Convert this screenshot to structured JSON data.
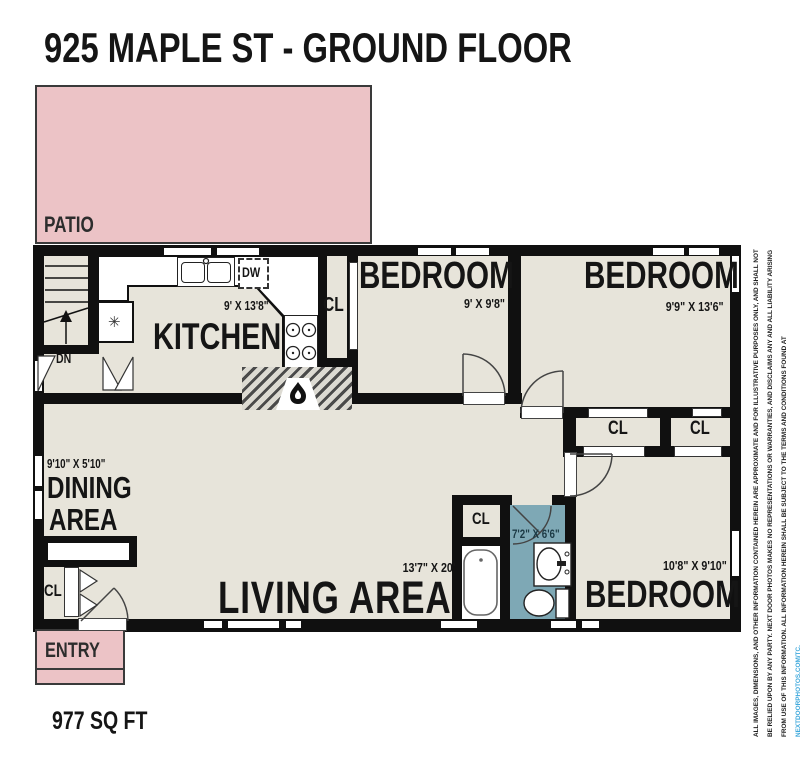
{
  "title": "925 MAPLE ST - GROUND FLOOR",
  "footer": {
    "area": "977 SQ FT"
  },
  "outdoor": {
    "patio": "PATIO",
    "entry": "ENTRY"
  },
  "rooms": {
    "kitchen": {
      "name": "KITCHEN",
      "dims": "9' X 13'8\""
    },
    "bedroom_top_left": {
      "name": "BEDROOM",
      "dims": "9' X 9'8\""
    },
    "bedroom_top_right": {
      "name": "BEDROOM",
      "dims": "9'9\" X 13'6\""
    },
    "bedroom_bottom_right": {
      "name": "BEDROOM",
      "dims": "10'8\" X 9'10\""
    },
    "dining": {
      "name_line1": "DINING",
      "name_line2": "AREA",
      "dims": "9'10\" X 5'10\""
    },
    "living": {
      "name": "LIVING AREA",
      "dims": "13'7\" X 20'"
    },
    "bathroom": {
      "dims": "7'2\" X 6'6\""
    }
  },
  "labels": {
    "closet": "CL",
    "stairs_down": "DN",
    "dishwasher": "DW",
    "snowflake": "✳"
  },
  "disclaimer": {
    "text": "ALL IMAGES, DIMENSIONS, AND OTHER INFORMATION CONTAINED HEREIN ARE APPROXIMATE AND FOR ILLUSTRATIVE PURPOSES ONLY, AND SHALL NOT BE RELIED UPON BY ANY PARTY. NEXT DOOR PHOTOS MAKES NO REPRESENTATIONS OR WARRANTIES, AND DISCLAIMS ANY AND ALL LIABILITY ARISING FROM USE OF THIS INFORMATION. ALL INFORMATION HEREIN SHALL BE SUBJECT TO THE TERMS AND CONDITIONS FOUND AT ",
    "link": "NEXTDOORPHOTOS.COM/TC."
  },
  "colors": {
    "patio_pink": "#ecc3c6",
    "bathroom_blue": "#7ea8b5",
    "floor_beige": "#e7e4da",
    "wall_black": "#101010",
    "link_blue": "#3fa9dc"
  }
}
